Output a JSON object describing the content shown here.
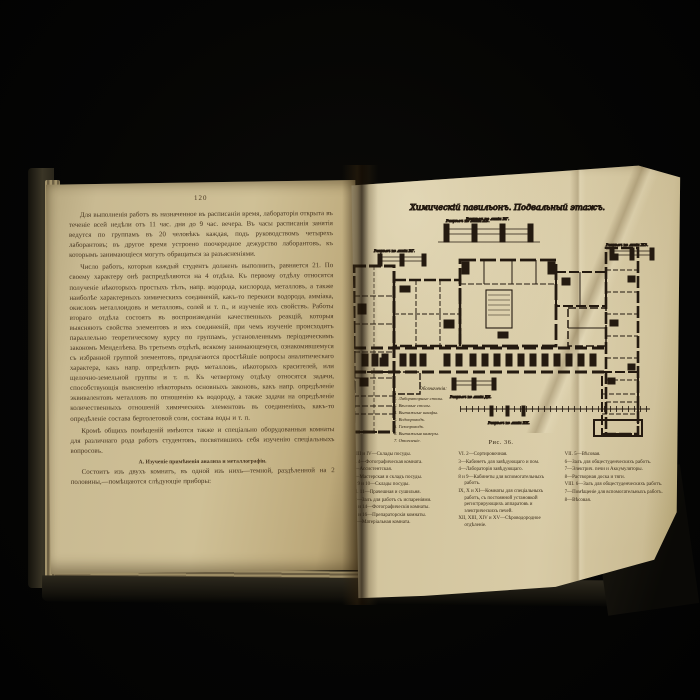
{
  "colors": {
    "background": "#050504",
    "page_left": "#cfc096",
    "page_right": "#d8cba6",
    "ink": "#241a10",
    "text": "#46341f",
    "cover": "#3a3526"
  },
  "left_page": {
    "page_number": "120",
    "paragraphs": [
      "Для выполненія работъ въ назначенное въ расписаніи время, лабораторія открыта въ теченіе всей недѣли отъ 11 час. дня до 9 час. вечера. Въ часы расписанія занятія ведутся по группамъ въ 20 человѣкъ каждая, подъ руководствомъ четырехъ лаборантовъ; въ другое время устроено поочередное дежурство лаборантовъ, къ которымъ занимающіеся могутъ обращаться за разъясненіями.",
      "Число работъ, которыя каждый студентъ долженъ выполнить, равняется 21. По своему характеру онѣ распредѣляются на 4 отдѣла. Къ первому отдѣлу относятся полученіе нѣкоторыхъ простыхъ тѣлъ, напр. водорода, кислорода, металловъ, а также наиболѣе характерныхъ химическихъ соединеній, какъ-то перекиси водорода, амміака, окисловъ металлоидовъ и металловъ, солей и т. п., и изученіе ихъ свойствъ. Работы втораго отдѣла состоятъ въ воспроизведеніи качественныхъ реакцій, которыя выясняютъ свойства элементовъ и ихъ соединеній, при чемъ изученіе происходитъ параллельно теоретическому курсу по группамъ, установленнымъ періодическимъ закономъ Менделѣева. Въ третьемъ отдѣлѣ, всякому занимающемуся, ознакомившемуся съ избранной группой элементовъ, предлагаются простѣйшіе вопросы аналитическаго характера, какъ напр. опредѣлить рядъ металловъ, нѣкоторыхъ красителей, или щелочно-земельной группы и т. п. Къ четвертому отдѣлу относятся задачи, способствующія выясненію нѣкоторыхъ основныхъ законовъ, какъ напр. опредѣленіе эквивалентовъ металловъ по отношенію къ водороду, а также задачи на опредѣленіе количественныхъ отношеній химическихъ элементовъ въ соединеніяхъ, какъ-то опредѣленіе состава бертолетовой соли, состава воды и т. п.",
      "Кромѣ общихъ помѣщеній имѣются также и спеціально оборудованныя комнаты для различнаго рода работъ студентовъ, посвятившихъ себя изученію спеціальныхъ вопросовъ."
    ],
    "section_heading": "А. Изученіе примѣненія анализа и металлографіи.",
    "closing_paragraph": "Состоитъ изъ двухъ комнатъ, въ одной изъ нихъ—темной, раздѣленной на 2 половины,—помѣщаются слѣдующіе приборы:"
  },
  "plate": {
    "title": "Химическій павильонъ. Подвальный этажъ.",
    "subtitle": "Разрѣзъ по линіи ВГ.",
    "section_labels": [
      "Разрѣзъ по линіи АБ.",
      "Разрѣзъ по линіи ВГ.",
      "Разрѣзъ по линіи ДЕ.",
      "Разрѣзъ по линіи ЖЗ.",
      "Разрѣзъ по линіи ИК."
    ],
    "figure_caption": "Рис. 36.",
    "symbols_legend": {
      "title": "Обозначенія:",
      "items": [
        "1. Лабораторные столы.",
        "2. Вѣсовые столы.",
        "3. Вытяжные шкафы.",
        "4. Водопроводъ.",
        "5. Газопроводъ.",
        "6. Вытяжныя камеры.",
        "7. Отопленіе."
      ]
    },
    "legend_columns": {
      "col1": [
        "I. III и IV—Склады посуды.",
        "II. 4—Фотографическая комната.",
        "7—Ассистентская.",
        "8—Мастерская и складъ посуды.",
        "V. 9 и 10—Склады посуды.",
        "VI. 11—Прачешная и сушильня.",
        "12—Залъ для работъ съ испареніями.",
        "13 и 14—Фотографическія комнаты.",
        "15 и 16—Препараторскія комнаты.",
        "17—Матеріальная комната."
      ],
      "col2": [
        "VI. 2—Сортировочная.",
        "3—Кабинетъ для завѣдующаго и пом.",
        "4—Лабораторія завѣдующаго.",
        "8 и 9—Кабинеты для вспомогательныхъ работъ.",
        "IX, X и XI—Комнаты для спеціальныхъ работъ, съ постоянной установкой регистрирующихъ аппаратовъ и электрическихъ печей.",
        "XII, XIII, XIV и XV—Сѣроводородное отдѣленіе."
      ],
      "col3": [
        "VII. 5—Вѣсовая.",
        "6—Залъ для общестуденческихъ работъ.",
        "7—Электрич. печи и Аккумуляторы.",
        "8—Растворная доска и тяги.",
        "VIII. 6—Залъ для общестуденческихъ работъ.",
        "7—Помѣщеніе для вспомогательныхъ работъ.",
        "8—Вѣсовая."
      ]
    }
  }
}
